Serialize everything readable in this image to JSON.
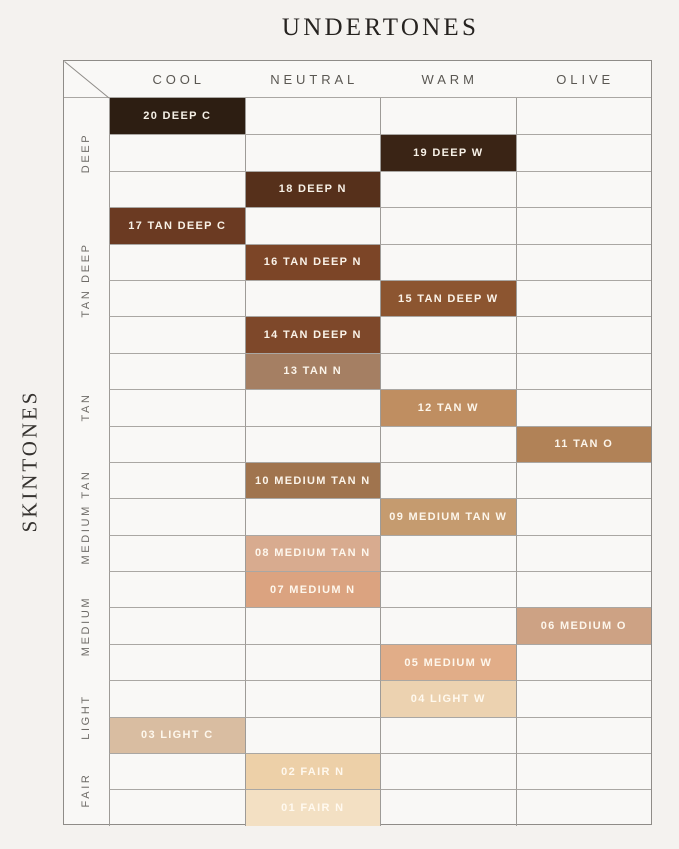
{
  "title": "UNDERTONES",
  "y_axis_title": "SKINTONES",
  "columns": [
    "COOL",
    "NEUTRAL",
    "WARM",
    "OLIVE"
  ],
  "row_groups": [
    {
      "label": "DEEP",
      "rows": 3
    },
    {
      "label": "TAN DEEP",
      "rows": 4
    },
    {
      "label": "TAN",
      "rows": 3
    },
    {
      "label": "MEDIUM TAN",
      "rows": 3
    },
    {
      "label": "MEDIUM",
      "rows": 3
    },
    {
      "label": "LIGHT",
      "rows": 2
    },
    {
      "label": "FAIR",
      "rows": 2
    }
  ],
  "chart_data": {
    "type": "heatmap",
    "x_axis_title": "UNDERTONES",
    "y_axis_title": "SKINTONES",
    "x_categories": [
      "COOL",
      "NEUTRAL",
      "WARM",
      "OLIVE"
    ],
    "y_categories": [
      "DEEP",
      "TAN DEEP",
      "TAN",
      "MEDIUM TAN",
      "MEDIUM",
      "LIGHT",
      "FAIR"
    ],
    "grid": "on",
    "legend": "none",
    "shades": [
      {
        "row": 1,
        "group": "DEEP",
        "column": "COOL",
        "label": "20 DEEP C",
        "color": "#2D1E12"
      },
      {
        "row": 2,
        "group": "DEEP",
        "column": "WARM",
        "label": "19 DEEP W",
        "color": "#3A2415"
      },
      {
        "row": 3,
        "group": "DEEP",
        "column": "NEUTRAL",
        "label": "18 DEEP N",
        "color": "#56301B"
      },
      {
        "row": 4,
        "group": "TAN DEEP",
        "column": "COOL",
        "label": "17 TAN DEEP C",
        "color": "#6B3A22"
      },
      {
        "row": 5,
        "group": "TAN DEEP",
        "column": "NEUTRAL",
        "label": "16 TAN DEEP N",
        "color": "#7C4527"
      },
      {
        "row": 6,
        "group": "TAN DEEP",
        "column": "WARM",
        "label": "15 TAN DEEP W",
        "color": "#8C5530"
      },
      {
        "row": 7,
        "group": "TAN DEEP",
        "column": "NEUTRAL",
        "label": "14 TAN DEEP N",
        "color": "#7E482A"
      },
      {
        "row": 8,
        "group": "TAN",
        "column": "NEUTRAL",
        "label": "13 TAN N",
        "color": "#A57F63"
      },
      {
        "row": 9,
        "group": "TAN",
        "column": "WARM",
        "label": "12 TAN W",
        "color": "#BF8E61"
      },
      {
        "row": 10,
        "group": "TAN",
        "column": "OLIVE",
        "label": "11 TAN O",
        "color": "#B18257"
      },
      {
        "row": 11,
        "group": "MEDIUM TAN",
        "column": "NEUTRAL",
        "label": "10 MEDIUM TAN N",
        "color": "#A0744E"
      },
      {
        "row": 12,
        "group": "MEDIUM TAN",
        "column": "WARM",
        "label": "09 MEDIUM TAN W",
        "color": "#C59B6F"
      },
      {
        "row": 13,
        "group": "MEDIUM TAN",
        "column": "NEUTRAL",
        "label": "08 MEDIUM TAN N",
        "color": "#D8AB8F"
      },
      {
        "row": 14,
        "group": "MEDIUM",
        "column": "NEUTRAL",
        "label": "07 MEDIUM N",
        "color": "#DBA380"
      },
      {
        "row": 15,
        "group": "MEDIUM",
        "column": "OLIVE",
        "label": "06 MEDIUM O",
        "color": "#CDA284"
      },
      {
        "row": 16,
        "group": "MEDIUM",
        "column": "WARM",
        "label": "05 MEDIUM W",
        "color": "#E1AD88"
      },
      {
        "row": 17,
        "group": "LIGHT",
        "column": "WARM",
        "label": "04 LIGHT W",
        "color": "#ECD2B0"
      },
      {
        "row": 18,
        "group": "LIGHT",
        "column": "COOL",
        "label": "03 LIGHT C",
        "color": "#D9BDA1"
      },
      {
        "row": 19,
        "group": "FAIR",
        "column": "NEUTRAL",
        "label": "02 FAIR N",
        "color": "#EDD0A8"
      },
      {
        "row": 20,
        "group": "FAIR",
        "column": "NEUTRAL",
        "label": "01 FAIR N",
        "color": "#F3E0C3"
      }
    ]
  },
  "colors": {
    "page_background": "#F4F2EF",
    "table_background": "#F9F8F6",
    "outer_border": "#8F8C88",
    "column_line": "#9E9B97",
    "row_line": "#AAA7A3",
    "header_text": "#5A5752",
    "shade_text": "#FDF8F0"
  }
}
